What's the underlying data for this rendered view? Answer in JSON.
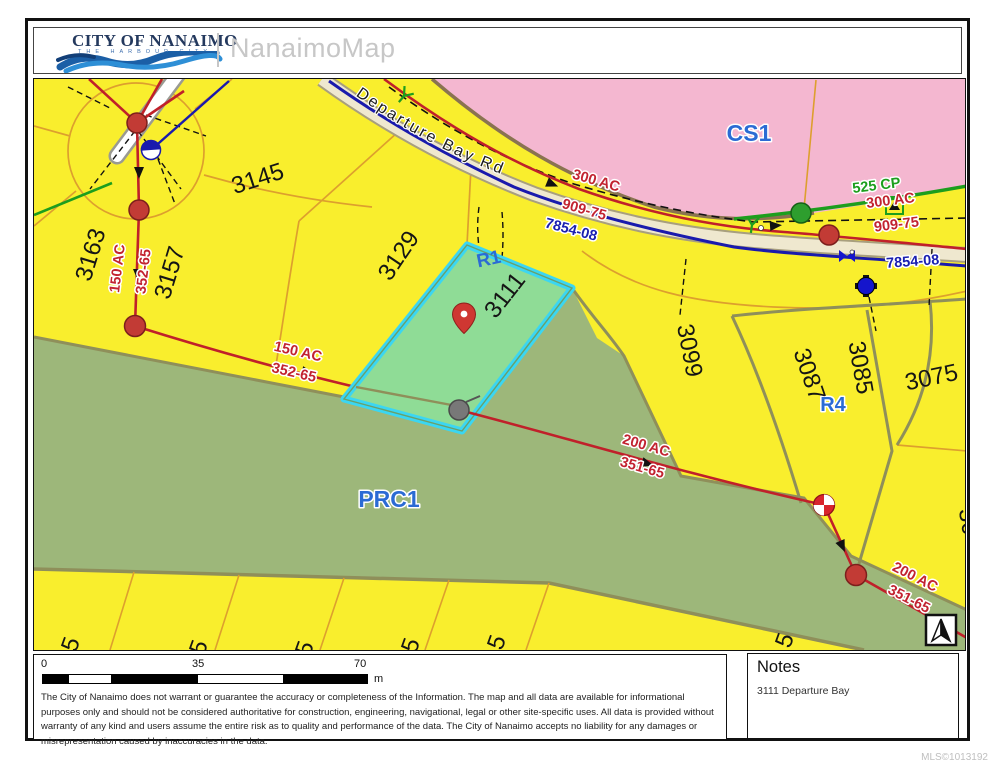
{
  "header": {
    "logo_line1": "CITY OF NANAIMO",
    "logo_line2": "THE HARBOUR CITY",
    "app_name": "NanaimoMap"
  },
  "map": {
    "road_name": "Departure Bay Rd",
    "zones": {
      "cs1": "CS1",
      "prc1": "PRC1",
      "r1": "R1",
      "r4": "R4"
    },
    "parcels": {
      "p3145": "3145",
      "p3163": "3163",
      "p3157": "3157",
      "p3129": "3129",
      "p3111": "3111",
      "p3099": "3099",
      "p3087": "3087",
      "p3085": "3085",
      "p3075": "3075",
      "edge_partial": "30",
      "bottom_partials": [
        "5",
        "5",
        "5",
        "5",
        "5",
        "5"
      ]
    },
    "utilities": {
      "l300": "300 AC",
      "l909": "909-75",
      "l785": "7854-08",
      "r525": "525 CP",
      "r300": "300 AC",
      "r909": "909-75",
      "r785": "7854-08",
      "v150": "150 AC",
      "v352": "352-65",
      "d150": "150 AC",
      "d352": "352-65",
      "m200": "200 AC",
      "m351": "351-65",
      "b200": "200 AC",
      "b351": "351-65"
    },
    "icons": {
      "map_pin": "location-pin",
      "north_arrow": "north-arrow",
      "manhole": "red-dot",
      "hydrant": "blue-hydrant",
      "valve": "bowtie-valve",
      "monument": "pie-circle"
    }
  },
  "footer": {
    "scale": {
      "t0": "0",
      "t35": "35",
      "t70": "70",
      "unit": "m"
    },
    "disclaimer": "The City of Nanaimo does not warrant or guarantee the accuracy or completeness of the Information. The map and all data are available for informational purposes only and should not be considered authoritative for construction, engineering, navigational, legal or other site-specific uses.  All data is provided without warranty of any kind and users assume the entire risk as to quality and performance of the data. The City of Nanaimo accepts no liability for any damages or misrepresentation caused by inaccuracies in the data.",
    "notes_title": "Notes",
    "notes_body": "3111 Departure Bay",
    "mls": "MLS©1013192"
  },
  "colors": {
    "parcel_yellow": "#f9ee2d",
    "commercial_pink": "#f4b7d0",
    "park_green": "#9db77a",
    "highlight_fill": "#8fdc96",
    "highlight_border": "#3bd6f2",
    "utility_red": "#c22330",
    "utility_blue": "#1a1fb0",
    "label_blue": "#2b6bd4",
    "survey_green": "#1d9e1d",
    "parcel_line_orange": "#dd9f2e"
  }
}
